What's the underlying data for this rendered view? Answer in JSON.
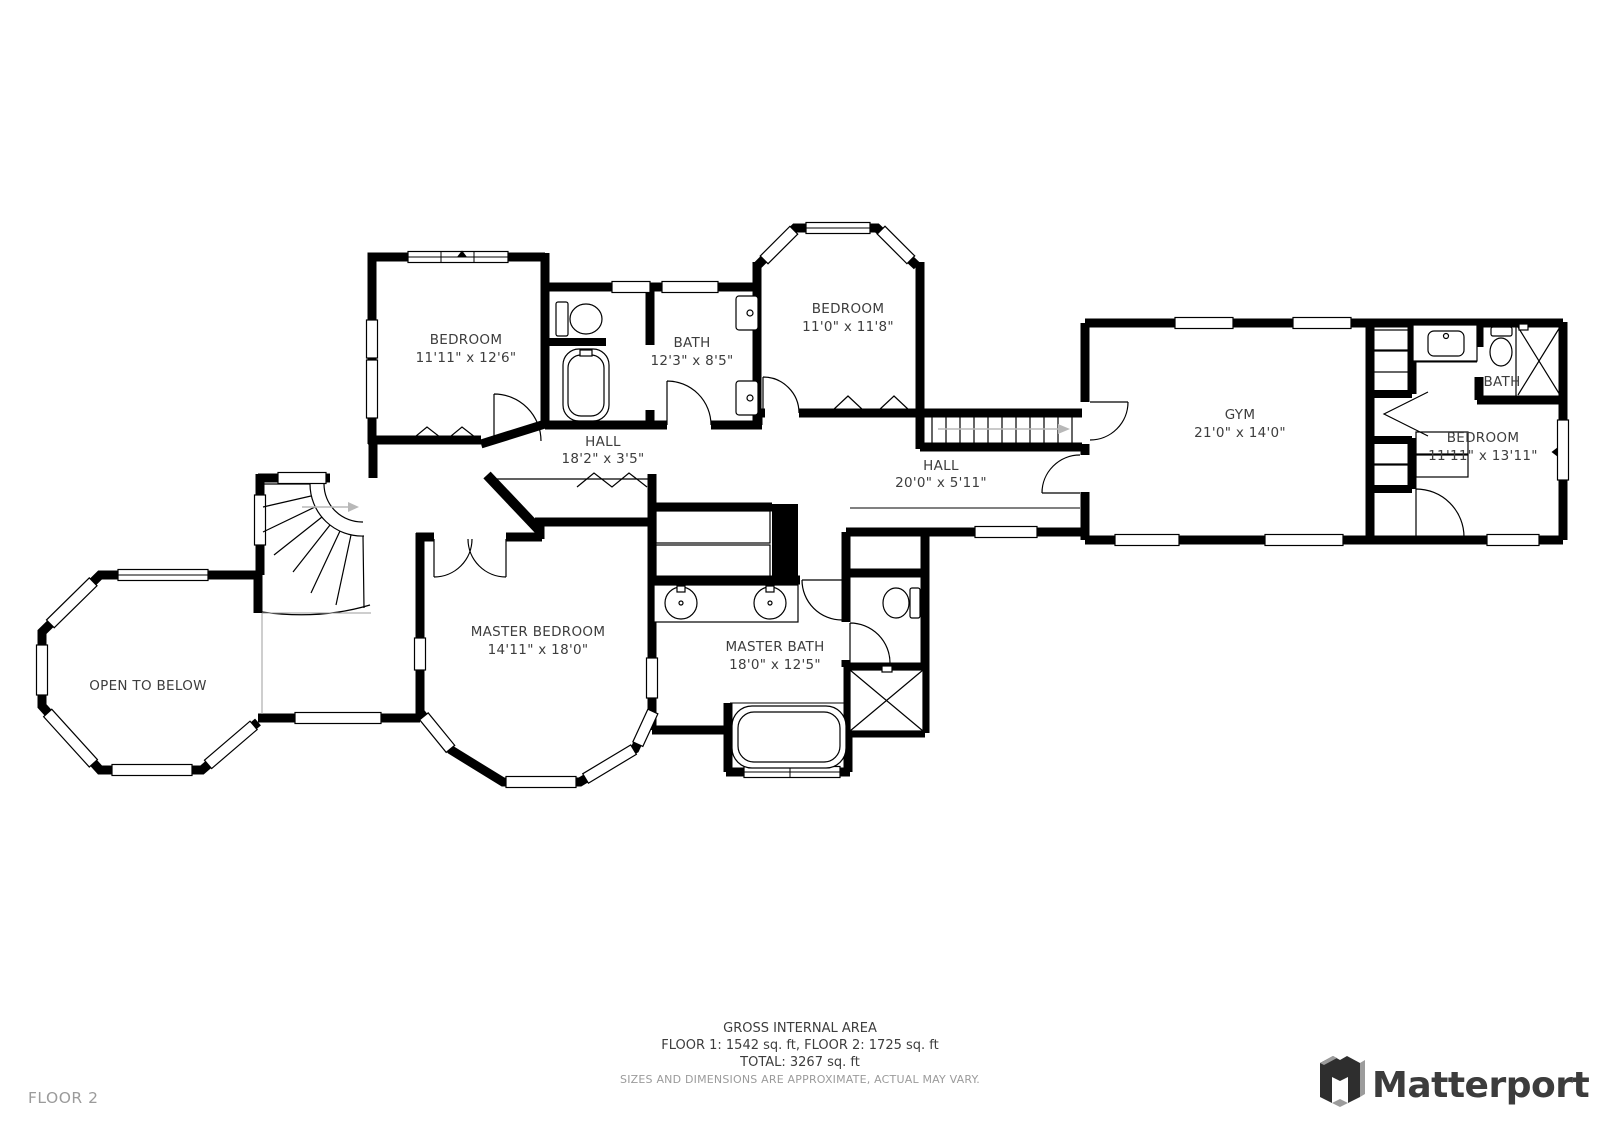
{
  "rooms": {
    "bedroom1": {
      "name": "BEDROOM",
      "dims": "11'11\" x 12'6\""
    },
    "bath1": {
      "name": "BATH",
      "dims": "12'3\" x 8'5\""
    },
    "bedroom2": {
      "name": "BEDROOM",
      "dims": "11'0\" x 11'8\""
    },
    "hall1": {
      "name": "HALL",
      "dims": "18'2\" x 3'5\""
    },
    "hall2": {
      "name": "HALL",
      "dims": "20'0\" x 5'11\""
    },
    "gym": {
      "name": "GYM",
      "dims": "21'0\" x 14'0\""
    },
    "bath2": {
      "name": "BATH"
    },
    "bedroom3": {
      "name": "BEDROOM",
      "dims": "11'11\" x 13'11\""
    },
    "master_bedroom": {
      "name": "MASTER BEDROOM",
      "dims": "14'11\" x 18'0\""
    },
    "master_bath": {
      "name": "MASTER BATH",
      "dims": "18'0\" x 12'5\""
    },
    "open_to_below": {
      "name": "OPEN TO BELOW"
    }
  },
  "footer": {
    "gross_area_title": "GROSS INTERNAL AREA",
    "floors_line": "FLOOR 1: 1542 sq. ft, FLOOR 2: 1725 sq. ft",
    "total_line": "TOTAL: 3267 sq. ft",
    "disclaimer": "SIZES AND DIMENSIONS ARE APPROXIMATE, ACTUAL MAY VARY."
  },
  "floor_label": "FLOOR 2",
  "brand": {
    "wordmark": "Matterport"
  },
  "colors": {
    "wall": "#000000",
    "label_text": "#3d3d3d",
    "muted_text": "#9b9b9b",
    "brand_text": "#3c3c3c"
  }
}
